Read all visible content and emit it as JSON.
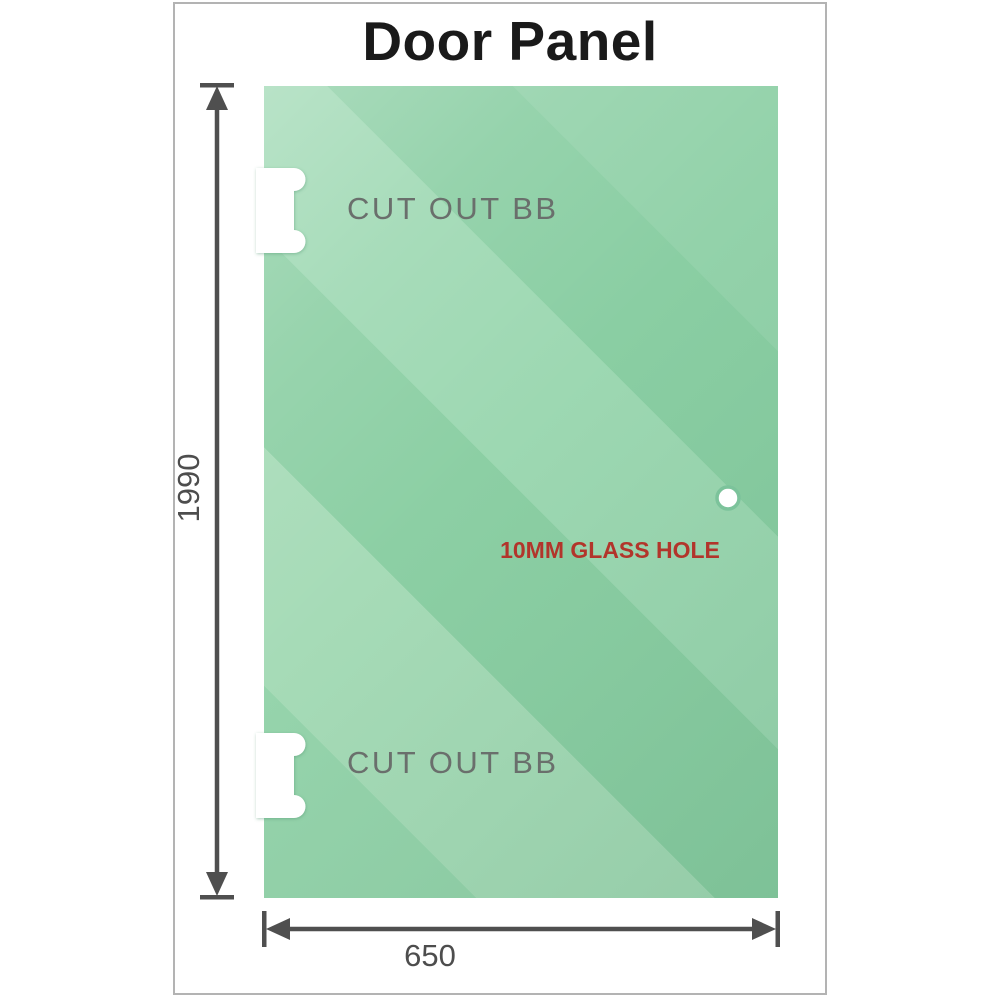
{
  "title": "Door Panel",
  "panel": {
    "cutouts": [
      {
        "label": "CUT OUT BB"
      },
      {
        "label": "CUT OUT BB"
      }
    ],
    "hole_label": "10MM GLASS HOLE"
  },
  "dimensions": {
    "height": "1990",
    "width": "650"
  },
  "icons": [
    "up-arrow-icon",
    "down-arrow-icon",
    "left-arrow-icon",
    "right-arrow-icon"
  ],
  "colors": {
    "glass_green_base": "#8ccfa4",
    "glass_green_light": "#a6dbb7",
    "glass_green_dark": "#8acea3",
    "dimension_gray": "#4f4f4f",
    "cutout_label_gray": "#6a6f6c",
    "hole_label_red": "#b2352b",
    "frame_border_gray": "#b3b3b3",
    "title_black": "#1a1a1a"
  }
}
